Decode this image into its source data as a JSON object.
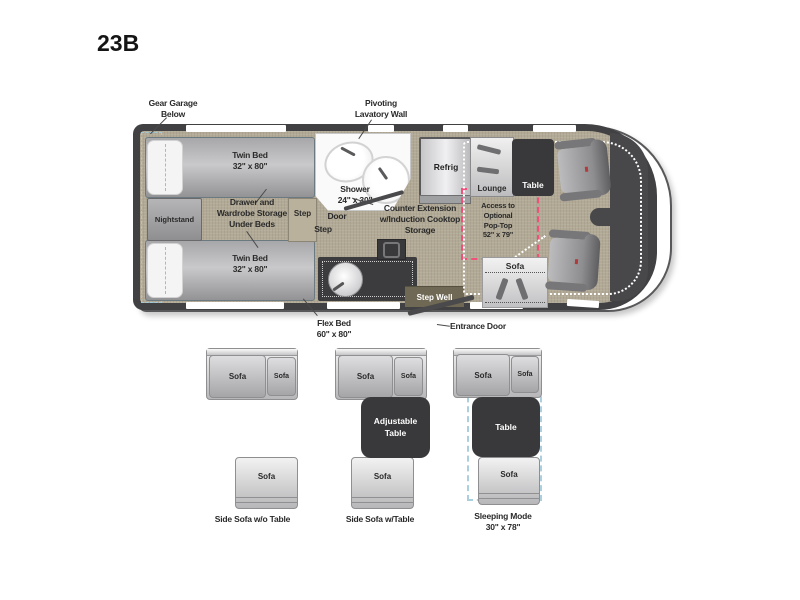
{
  "title": "23B",
  "colors": {
    "wall": "#414143",
    "floor": "#b2aa96",
    "furniture_dark": "#39383a",
    "accent_red": "#f0507a",
    "accent_blue": "#a2cbdc",
    "stepwell_brown": "#6f6854"
  },
  "plan": {
    "gear_garage": [
      "Gear Garage",
      "Below"
    ],
    "pivoting_lavatory": [
      "Pivoting",
      "Lavatory Wall"
    ],
    "twin_bed": [
      "Twin Bed",
      "32\" x 80\""
    ],
    "nightstand": "Nightstand",
    "storage": [
      "Drawer and",
      "Wardrobe Storage",
      "Under Beds"
    ],
    "step": "Step",
    "door": "Door",
    "shower": [
      "Shower",
      "24\" x 30\""
    ],
    "counter": [
      "Counter Extension",
      "w/Induction Cooktop",
      "Storage"
    ],
    "refrig": "Refrig",
    "lounge": "Lounge",
    "table": "Table",
    "pop_top": [
      "Access to",
      "Optional",
      "Pop-Top",
      "52\" x 79\""
    ],
    "sofa": "Sofa",
    "step_well": "Step Well",
    "entrance_door": "Entrance Door",
    "flex_bed": [
      "Flex Bed",
      "60\" x 80\""
    ]
  },
  "configs": [
    {
      "seat_left": "Sofa",
      "seat_right": "Sofa",
      "seat_bottom": "Sofa",
      "caption": [
        "Side Sofa w/o Table"
      ]
    },
    {
      "seat_left": "Sofa",
      "seat_right": "Sofa",
      "seat_bottom": "Sofa",
      "table": [
        "Adjustable",
        "Table"
      ],
      "caption": [
        "Side Sofa w/Table"
      ]
    },
    {
      "seat_left": "Sofa",
      "seat_right": "Sofa",
      "seat_bottom": "Sofa",
      "table": [
        "Table"
      ],
      "caption": [
        "Sleeping Mode",
        "30\" x 78\""
      ]
    }
  ]
}
